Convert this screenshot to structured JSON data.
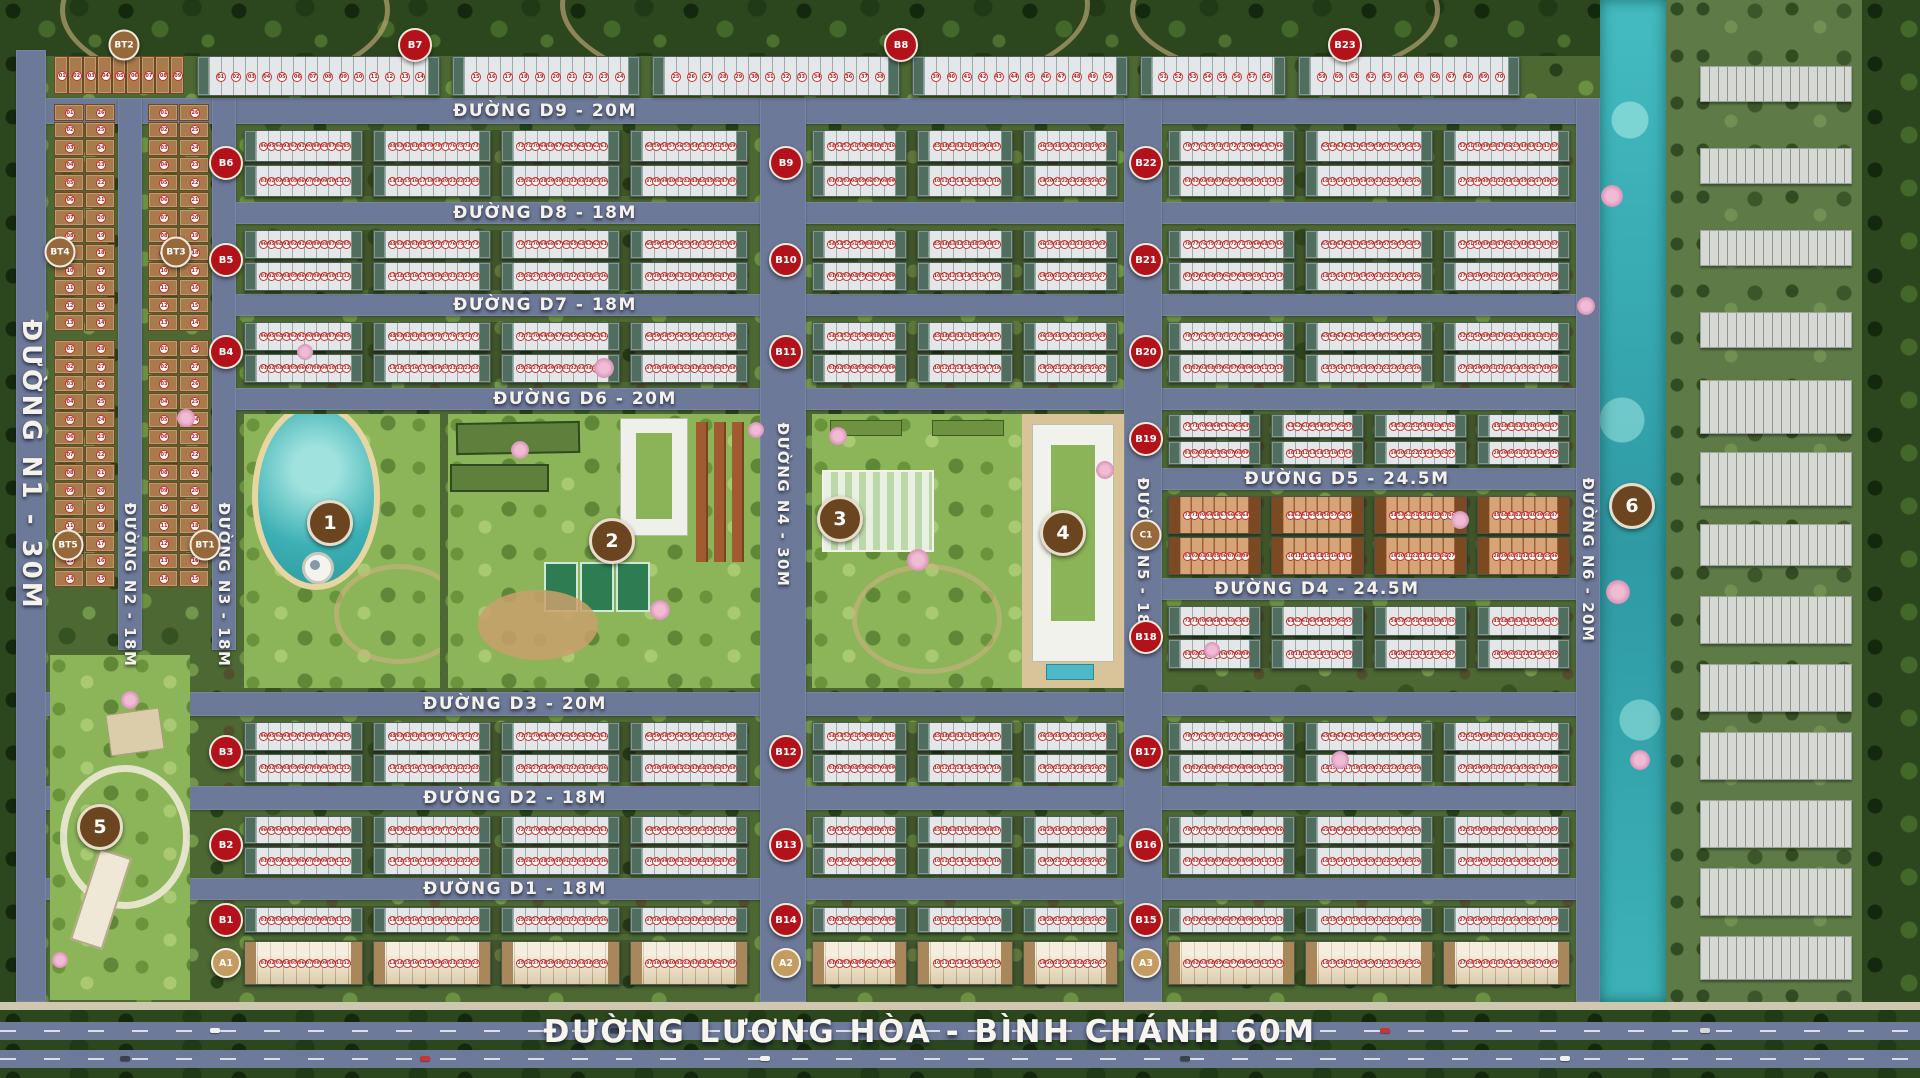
{
  "roads": {
    "horizontal": [
      {
        "id": "D9",
        "label": "ĐƯỜNG D9 - 20M",
        "x": 46,
        "y": 98,
        "w": 1554,
        "h": 26,
        "label_cx": 545
      },
      {
        "id": "D8",
        "label": "ĐƯỜNG D8 - 18M",
        "x": 236,
        "y": 202,
        "w": 1364,
        "h": 22,
        "label_cx": 545
      },
      {
        "id": "D7",
        "label": "ĐƯỜNG D7 - 18M",
        "x": 236,
        "y": 294,
        "w": 1364,
        "h": 22,
        "label_cx": 545
      },
      {
        "id": "D6",
        "label": "ĐƯỜNG D6 - 20M",
        "x": 236,
        "y": 388,
        "w": 1364,
        "h": 22,
        "label_cx": 585
      },
      {
        "id": "D5",
        "label": "ĐƯỜNG D5 - 24.5M",
        "x": 1124,
        "y": 468,
        "w": 476,
        "h": 22,
        "label_cx": 1347
      },
      {
        "id": "D4",
        "label": "ĐƯỜNG D4 - 24.5M",
        "x": 1124,
        "y": 578,
        "w": 476,
        "h": 22,
        "label_cx": 1317
      },
      {
        "id": "D3",
        "label": "ĐƯỜNG D3 - 20M",
        "x": 46,
        "y": 692,
        "w": 1554,
        "h": 24,
        "label_cx": 515
      },
      {
        "id": "D2",
        "label": "ĐƯỜNG D2 - 18M",
        "x": 46,
        "y": 786,
        "w": 1554,
        "h": 24,
        "label_cx": 515
      },
      {
        "id": "D1",
        "label": "ĐƯỜNG D1 - 18M",
        "x": 46,
        "y": 878,
        "w": 1554,
        "h": 22,
        "label_cx": 515
      }
    ],
    "vertical": [
      {
        "id": "N1",
        "label": "ĐƯỜNG N1 - 30M",
        "x": 16,
        "y": 50,
        "w": 30,
        "h": 952,
        "label_cy": 465,
        "big": true
      },
      {
        "id": "N2",
        "label": "ĐƯỜNG N2 - 18M",
        "x": 118,
        "y": 98,
        "w": 24,
        "h": 552,
        "label_cy": 585
      },
      {
        "id": "N3",
        "label": "ĐƯỜNG N3 - 18M",
        "x": 212,
        "y": 98,
        "w": 24,
        "h": 552,
        "label_cy": 585
      },
      {
        "id": "N4",
        "label": "ĐƯỜNG N4 - 30M",
        "x": 760,
        "y": 98,
        "w": 46,
        "h": 904,
        "label_cy": 505
      },
      {
        "id": "N5",
        "label": "ĐƯỜNG N5 - 18M",
        "x": 1124,
        "y": 98,
        "w": 38,
        "h": 904,
        "label_cy": 560
      },
      {
        "id": "N6",
        "label": "ĐƯỜNG N6 - 20M",
        "x": 1576,
        "y": 98,
        "w": 24,
        "h": 904,
        "label_cy": 560
      }
    ],
    "avenue": {
      "label": "ĐƯỜNG LƯƠNG HÒA - BÌNH CHÁNH 60M",
      "y": 1002,
      "h": 76,
      "label_cx": 930,
      "label_cy": 1032
    }
  },
  "sectors": {
    "left": {
      "x": 244,
      "w": 504,
      "strips": 4
    },
    "mid": {
      "x": 812,
      "w": 306,
      "strips": 3
    },
    "right": {
      "x": 1168,
      "w": 402,
      "strips": 3
    }
  },
  "rows": [
    {
      "y": 130,
      "h": 66,
      "double": true,
      "style": "white",
      "sectors": [
        "left",
        "mid",
        "right"
      ]
    },
    {
      "y": 230,
      "h": 60,
      "double": true,
      "style": "white",
      "sectors": [
        "left",
        "mid",
        "right"
      ]
    },
    {
      "y": 322,
      "h": 60,
      "double": true,
      "style": "white",
      "sectors": [
        "left",
        "mid",
        "right"
      ]
    },
    {
      "y": 414,
      "h": 50,
      "double": true,
      "style": "white",
      "custom": {
        "x": 1168,
        "w": 402,
        "strips": 4
      }
    },
    {
      "y": 496,
      "h": 78,
      "double": true,
      "style": "brown",
      "custom": {
        "x": 1168,
        "w": 402,
        "strips": 4
      }
    },
    {
      "y": 606,
      "h": 62,
      "double": true,
      "style": "white",
      "custom": {
        "x": 1168,
        "w": 402,
        "strips": 4
      }
    },
    {
      "y": 722,
      "h": 60,
      "double": true,
      "style": "white",
      "sectors": [
        "left",
        "mid",
        "right"
      ]
    },
    {
      "y": 816,
      "h": 58,
      "double": true,
      "style": "white",
      "sectors": [
        "left",
        "mid",
        "right"
      ]
    },
    {
      "y": 906,
      "h": 28,
      "double": false,
      "style": "white",
      "sectors": [
        "left",
        "mid",
        "right"
      ]
    },
    {
      "y": 940,
      "h": 46,
      "double": false,
      "style": "cream",
      "sectors": [
        "left",
        "mid",
        "right"
      ]
    }
  ],
  "top_row": {
    "y": 56,
    "h": 40,
    "strips": [
      {
        "x": 197,
        "w": 243
      },
      {
        "x": 452,
        "w": 188
      },
      {
        "x": 652,
        "w": 248
      },
      {
        "x": 912,
        "w": 216
      },
      {
        "x": 1140,
        "w": 146
      },
      {
        "x": 1298,
        "w": 222
      }
    ],
    "villa_strip": {
      "x": 54,
      "w": 130,
      "cells": 9
    }
  },
  "villas": {
    "groups": [
      {
        "x": 54,
        "y": 104,
        "w": 62,
        "h": 228,
        "rows": 13
      },
      {
        "x": 148,
        "y": 104,
        "w": 62,
        "h": 228,
        "rows": 13
      },
      {
        "x": 54,
        "y": 340,
        "w": 62,
        "h": 248,
        "rows": 14
      },
      {
        "x": 148,
        "y": 340,
        "w": 62,
        "h": 248,
        "rows": 14
      }
    ]
  },
  "badges": [
    {
      "code": "BT2",
      "cx": 124,
      "cy": 45,
      "type": "brown"
    },
    {
      "code": "B7",
      "cx": 415,
      "cy": 45,
      "type": "red"
    },
    {
      "code": "B8",
      "cx": 901,
      "cy": 45,
      "type": "red"
    },
    {
      "code": "B23",
      "cx": 1345,
      "cy": 45,
      "type": "red"
    },
    {
      "code": "B6",
      "cx": 226,
      "cy": 163,
      "type": "red"
    },
    {
      "code": "B5",
      "cx": 226,
      "cy": 260,
      "type": "red"
    },
    {
      "code": "B4",
      "cx": 226,
      "cy": 352,
      "type": "red"
    },
    {
      "code": "B3",
      "cx": 226,
      "cy": 752,
      "type": "red"
    },
    {
      "code": "B2",
      "cx": 226,
      "cy": 845,
      "type": "red"
    },
    {
      "code": "B1",
      "cx": 226,
      "cy": 920,
      "type": "red"
    },
    {
      "code": "A1",
      "cx": 226,
      "cy": 963,
      "type": "tan"
    },
    {
      "code": "B9",
      "cx": 786,
      "cy": 163,
      "type": "red"
    },
    {
      "code": "B10",
      "cx": 786,
      "cy": 260,
      "type": "red"
    },
    {
      "code": "B11",
      "cx": 786,
      "cy": 352,
      "type": "red"
    },
    {
      "code": "B12",
      "cx": 786,
      "cy": 752,
      "type": "red"
    },
    {
      "code": "B13",
      "cx": 786,
      "cy": 845,
      "type": "red"
    },
    {
      "code": "B14",
      "cx": 786,
      "cy": 920,
      "type": "red"
    },
    {
      "code": "A2",
      "cx": 786,
      "cy": 963,
      "type": "tan"
    },
    {
      "code": "B22",
      "cx": 1146,
      "cy": 163,
      "type": "red"
    },
    {
      "code": "B21",
      "cx": 1146,
      "cy": 260,
      "type": "red"
    },
    {
      "code": "B20",
      "cx": 1146,
      "cy": 352,
      "type": "red"
    },
    {
      "code": "B19",
      "cx": 1146,
      "cy": 439,
      "type": "red"
    },
    {
      "code": "C1",
      "cx": 1146,
      "cy": 535,
      "type": "brown"
    },
    {
      "code": "B18",
      "cx": 1146,
      "cy": 637,
      "type": "red"
    },
    {
      "code": "B17",
      "cx": 1146,
      "cy": 752,
      "type": "red"
    },
    {
      "code": "B16",
      "cx": 1146,
      "cy": 845,
      "type": "red"
    },
    {
      "code": "B15",
      "cx": 1146,
      "cy": 920,
      "type": "red"
    },
    {
      "code": "A3",
      "cx": 1146,
      "cy": 963,
      "type": "tan"
    },
    {
      "code": "BT4",
      "cx": 60,
      "cy": 252,
      "type": "brown"
    },
    {
      "code": "BT3",
      "cx": 176,
      "cy": 252,
      "type": "brown"
    },
    {
      "code": "BT5",
      "cx": 68,
      "cy": 545,
      "type": "brown"
    },
    {
      "code": "BT1",
      "cx": 205,
      "cy": 545,
      "type": "brown"
    }
  ],
  "amenities": [
    {
      "num": "1",
      "cx": 330,
      "cy": 523
    },
    {
      "num": "2",
      "cx": 612,
      "cy": 541
    },
    {
      "num": "3",
      "cx": 840,
      "cy": 519
    },
    {
      "num": "4",
      "cx": 1063,
      "cy": 533
    },
    {
      "num": "5",
      "cx": 100,
      "cy": 827
    },
    {
      "num": "6",
      "cx": 1632,
      "cy": 506
    }
  ],
  "offsite_blocks": [
    {
      "y": 66,
      "h": 34
    },
    {
      "y": 148,
      "h": 34
    },
    {
      "y": 230,
      "h": 34
    },
    {
      "y": 312,
      "h": 34
    },
    {
      "y": 380,
      "h": 52
    },
    {
      "y": 452,
      "h": 52
    },
    {
      "y": 524,
      "h": 40
    },
    {
      "y": 596,
      "h": 46
    },
    {
      "y": 664,
      "h": 46
    },
    {
      "y": 732,
      "h": 46
    },
    {
      "y": 800,
      "h": 46
    },
    {
      "y": 868,
      "h": 46
    },
    {
      "y": 936,
      "h": 42
    }
  ],
  "blossoms": [
    {
      "x": 186,
      "y": 418,
      "r": 9
    },
    {
      "x": 305,
      "y": 352,
      "r": 8
    },
    {
      "x": 604,
      "y": 368,
      "r": 10
    },
    {
      "x": 838,
      "y": 436,
      "r": 9
    },
    {
      "x": 918,
      "y": 560,
      "r": 11
    },
    {
      "x": 1105,
      "y": 470,
      "r": 9
    },
    {
      "x": 1212,
      "y": 650,
      "r": 8
    },
    {
      "x": 1340,
      "y": 760,
      "r": 9
    },
    {
      "x": 1612,
      "y": 196,
      "r": 11
    },
    {
      "x": 1618,
      "y": 592,
      "r": 12
    },
    {
      "x": 1640,
      "y": 760,
      "r": 10
    },
    {
      "x": 1586,
      "y": 306,
      "r": 9
    },
    {
      "x": 660,
      "y": 610,
      "r": 10
    },
    {
      "x": 756,
      "y": 430,
      "r": 8
    },
    {
      "x": 520,
      "y": 450,
      "r": 9
    },
    {
      "x": 130,
      "y": 700,
      "r": 9
    },
    {
      "x": 60,
      "y": 960,
      "r": 8
    },
    {
      "x": 1460,
      "y": 520,
      "r": 9
    }
  ],
  "cars": [
    {
      "x": 210,
      "l": 0,
      "c": "#f2f2f2"
    },
    {
      "x": 420,
      "l": 1,
      "c": "#cc3333"
    },
    {
      "x": 610,
      "l": 0,
      "c": "#39414f"
    },
    {
      "x": 760,
      "l": 1,
      "c": "#f2f2f2"
    },
    {
      "x": 980,
      "l": 0,
      "c": "#d8d8d8"
    },
    {
      "x": 1180,
      "l": 1,
      "c": "#39414f"
    },
    {
      "x": 1380,
      "l": 0,
      "c": "#cc3333"
    },
    {
      "x": 1560,
      "l": 1,
      "c": "#f2f2f2"
    },
    {
      "x": 1700,
      "l": 0,
      "c": "#d8d8d8"
    },
    {
      "x": 120,
      "l": 1,
      "c": "#39414f"
    },
    {
      "x": 860,
      "l": 0,
      "c": "#f2f2f2"
    },
    {
      "x": 1260,
      "l": 0,
      "c": "#d8d8d8"
    }
  ]
}
